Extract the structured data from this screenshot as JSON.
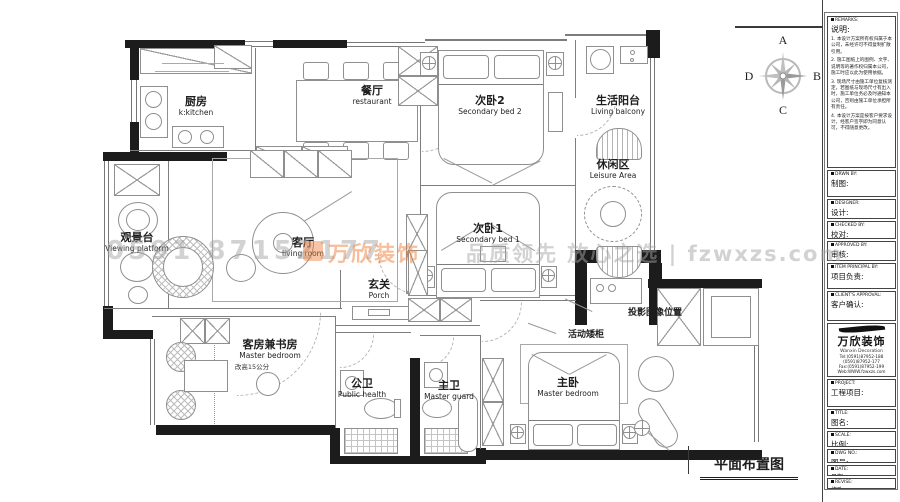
{
  "drawing_title": "平面布置图",
  "compass": {
    "top": "A",
    "right": "B",
    "bottom": "C",
    "left": "D"
  },
  "rooms": {
    "kitchen": {
      "zh": "厨房",
      "en": "k:kitchen"
    },
    "dining": {
      "zh": "餐厅",
      "en": "restaurant"
    },
    "bed2": {
      "zh": "次卧2",
      "en": "Secondary bed 2"
    },
    "balcony": {
      "zh": "生活阳台",
      "en": "Living balcony"
    },
    "leisure": {
      "zh": "休闲区",
      "en": "Leisure Area"
    },
    "viewing": {
      "zh": "观景台",
      "en": "Viewing platform"
    },
    "living": {
      "zh": "客厅",
      "en": "living room"
    },
    "bed1": {
      "zh": "次卧1",
      "en": "Secondary bed 1"
    },
    "porch": {
      "zh": "玄关",
      "en": "Porch"
    },
    "guest": {
      "zh": "客房兼书房",
      "en": "Master bedroom",
      "note": "改高15公分"
    },
    "public_bath": {
      "zh": "公卫",
      "en": "Public health"
    },
    "master_bath": {
      "zh": "主卫",
      "en": "Master guard"
    },
    "master_bed": {
      "zh": "主卧",
      "en": "Master bedroom"
    }
  },
  "annotations": {
    "projection": "投影图像位置",
    "cabinet": "活动矮柜"
  },
  "watermark": {
    "phone": "0591 87152177",
    "logo": "万欣装饰",
    "slogan": "品质领先 放心之选 | fzwxzs.com"
  },
  "titleblock": {
    "remarks": {
      "en": "REMARKS:",
      "zh": "说明:",
      "notes": [
        "1. 本设计方案所有权归属于本公司，未经许可不得复制扩散引用。",
        "2. 施工图纸上的图例、文字、说明等的著作权归属本公司，施工时应以此为使用依据。",
        "3. 现场尺寸由施工单位复核测定，若图纸与现场尺寸有出入时，施工单位务必及时通知本公司，否则由施工单位承担所有责任。",
        "4. 本设计方案是按客户要求设计，经客户签字即为同意认可，不得随意更改。"
      ]
    },
    "fields": [
      {
        "en": "DRWN BY:",
        "zh": "制图:"
      },
      {
        "en": "DESIGNER:",
        "zh": "设计:"
      },
      {
        "en": "CHECKED BY:",
        "zh": "校对:"
      },
      {
        "en": "APPROVED BY:",
        "zh": "审核:"
      },
      {
        "en": "ITEM PRINCIPAL BY:",
        "zh": "项目负责:"
      },
      {
        "en": "CLIENT'S APPROVAL:",
        "zh": "客户确认:"
      }
    ],
    "company": {
      "logo_zh": "万欣装饰",
      "logo_en": "Wanxin Decoration",
      "lines": [
        "Tel:(0591)87952-188",
        "(0591)87952-177",
        "Fax:(0591)87952-199",
        "Web:WWW.fzwxzs.com"
      ]
    },
    "fields2": [
      {
        "en": "PROJECT:",
        "zh": "工程项目:"
      },
      {
        "en": "TITLE:",
        "zh": "图名:"
      },
      {
        "en": "SCALE:",
        "zh": "比例:"
      },
      {
        "en": "DWG NO.:",
        "zh": "图号:"
      },
      {
        "en": "DATE:",
        "zh": "日期:"
      },
      {
        "en": "REVISE:",
        "zh": "修改:"
      }
    ]
  }
}
